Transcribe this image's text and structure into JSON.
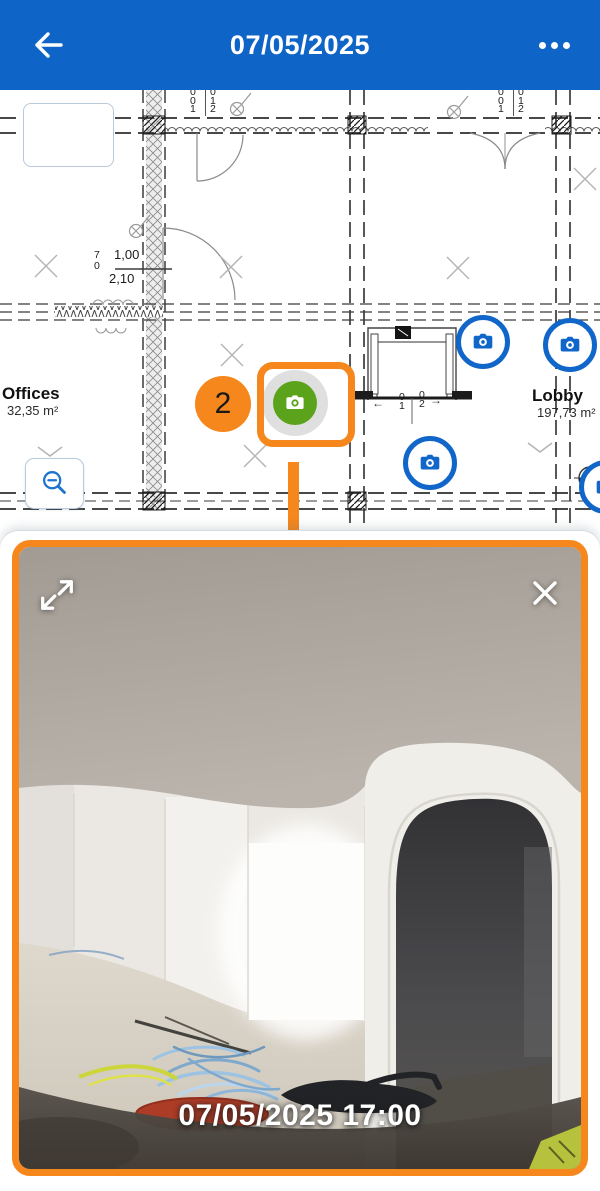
{
  "header": {
    "title": "07/05/2025"
  },
  "plan": {
    "rooms": [
      {
        "name": "Offices",
        "area": "32,35 m²"
      },
      {
        "name": "Lobby",
        "area": "197,73 m²"
      }
    ],
    "door_dimension": {
      "width": "1,00",
      "height": "2,10",
      "tag_top": "7",
      "tag_bottom": "0"
    },
    "ticks": {
      "a": [
        "0",
        "0",
        "1"
      ],
      "b": [
        "0",
        "1",
        "2"
      ],
      "elevator_a": [
        "0",
        "1"
      ],
      "elevator_b": [
        "0",
        "2"
      ],
      "arrow_left": "←",
      "arrow_right": "→"
    },
    "annotation": {
      "step_number": "2"
    }
  },
  "photo_viewer": {
    "timestamp": "07/05/2025 17:00"
  },
  "colors": {
    "header_blue": "#0E64C7",
    "accent_orange": "#F5871D",
    "marker_green": "#5CA31C",
    "marker_blue": "#1166C9",
    "timestamp_red": "#AD3C27"
  }
}
